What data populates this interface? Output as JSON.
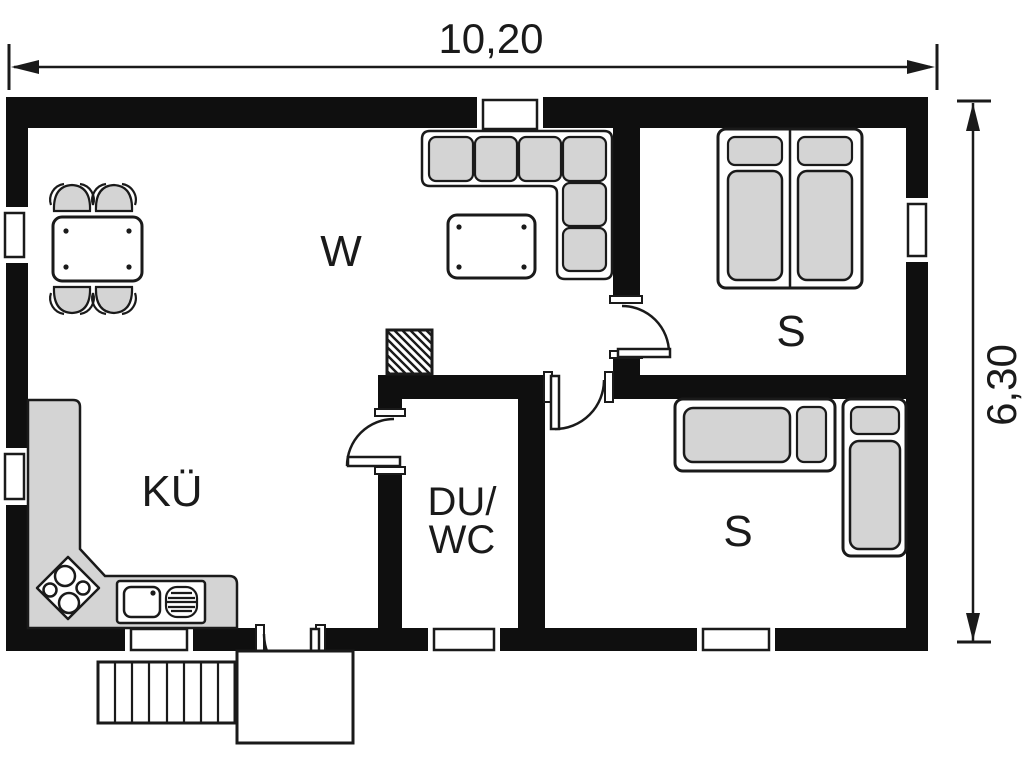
{
  "plan": {
    "type": "floor-plan",
    "dimensions": {
      "width_label": "10,20",
      "height_label": "6,30"
    },
    "rooms": {
      "living": "W",
      "kitchen": "KÜ",
      "bath_line1": "DU/",
      "bath_line2": "WC",
      "bedroom_upper": "S",
      "bedroom_lower": "S"
    },
    "colors": {
      "wall": "#0f0f0f",
      "line": "#1a1a1a",
      "furniture": "#d4d4d4",
      "background": "#ffffff"
    }
  }
}
